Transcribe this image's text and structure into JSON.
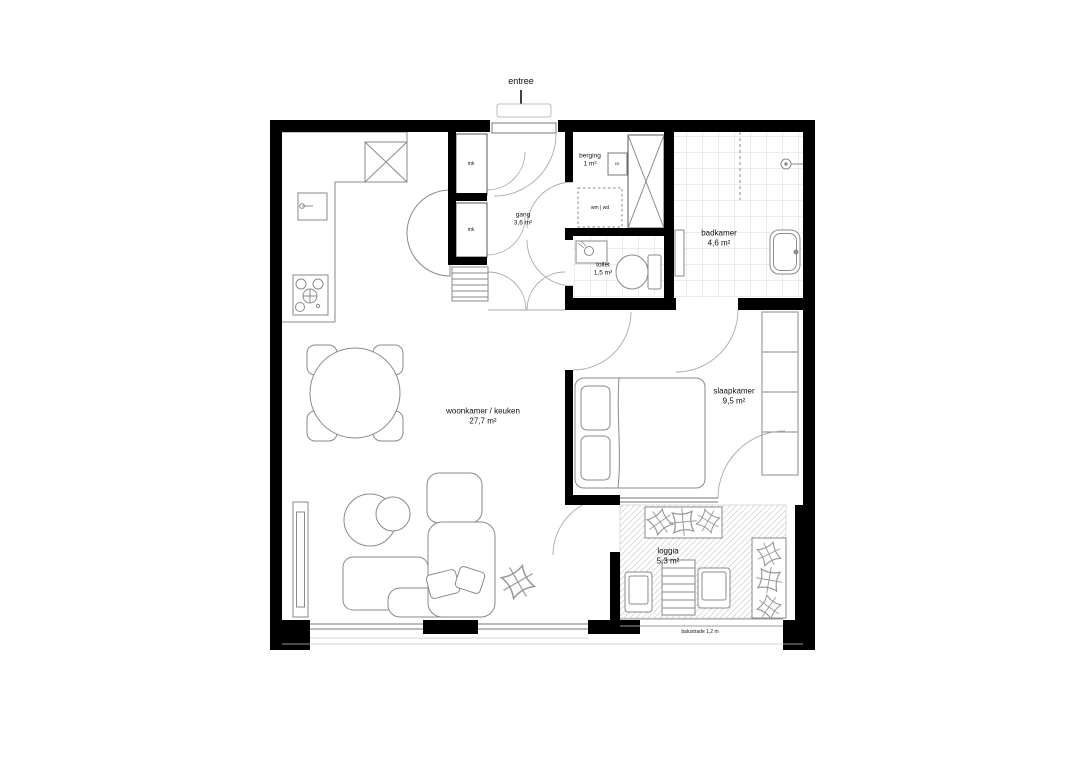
{
  "entree": {
    "label": "entree"
  },
  "rooms": {
    "woonkamer": {
      "name": "woonkamer / keuken",
      "area": "27,7 m²"
    },
    "slaapkamer": {
      "name": "slaapkamer",
      "area": "9,5 m²"
    },
    "badkamer": {
      "name": "badkamer",
      "area": "4,6 m²"
    },
    "toilet": {
      "name": "toilet",
      "area": "1,5 m²"
    },
    "gang": {
      "name": "gang",
      "area": "3,6 m²"
    },
    "berging": {
      "name": "berging",
      "area": "1 m²"
    },
    "loggia": {
      "name": "loggia",
      "area": "5,3 m²"
    }
  },
  "annotations": {
    "wm_wd": "wm | wd",
    "mk_top": "mk",
    "mk_bottom": "mk",
    "unit": "cv",
    "balustrade": "balustrade 1,2 m"
  },
  "colors": {
    "wall": "#000000",
    "furniture_line": "#8a8a8a",
    "tile_line": "#d9d9d9",
    "background": "#ffffff"
  }
}
